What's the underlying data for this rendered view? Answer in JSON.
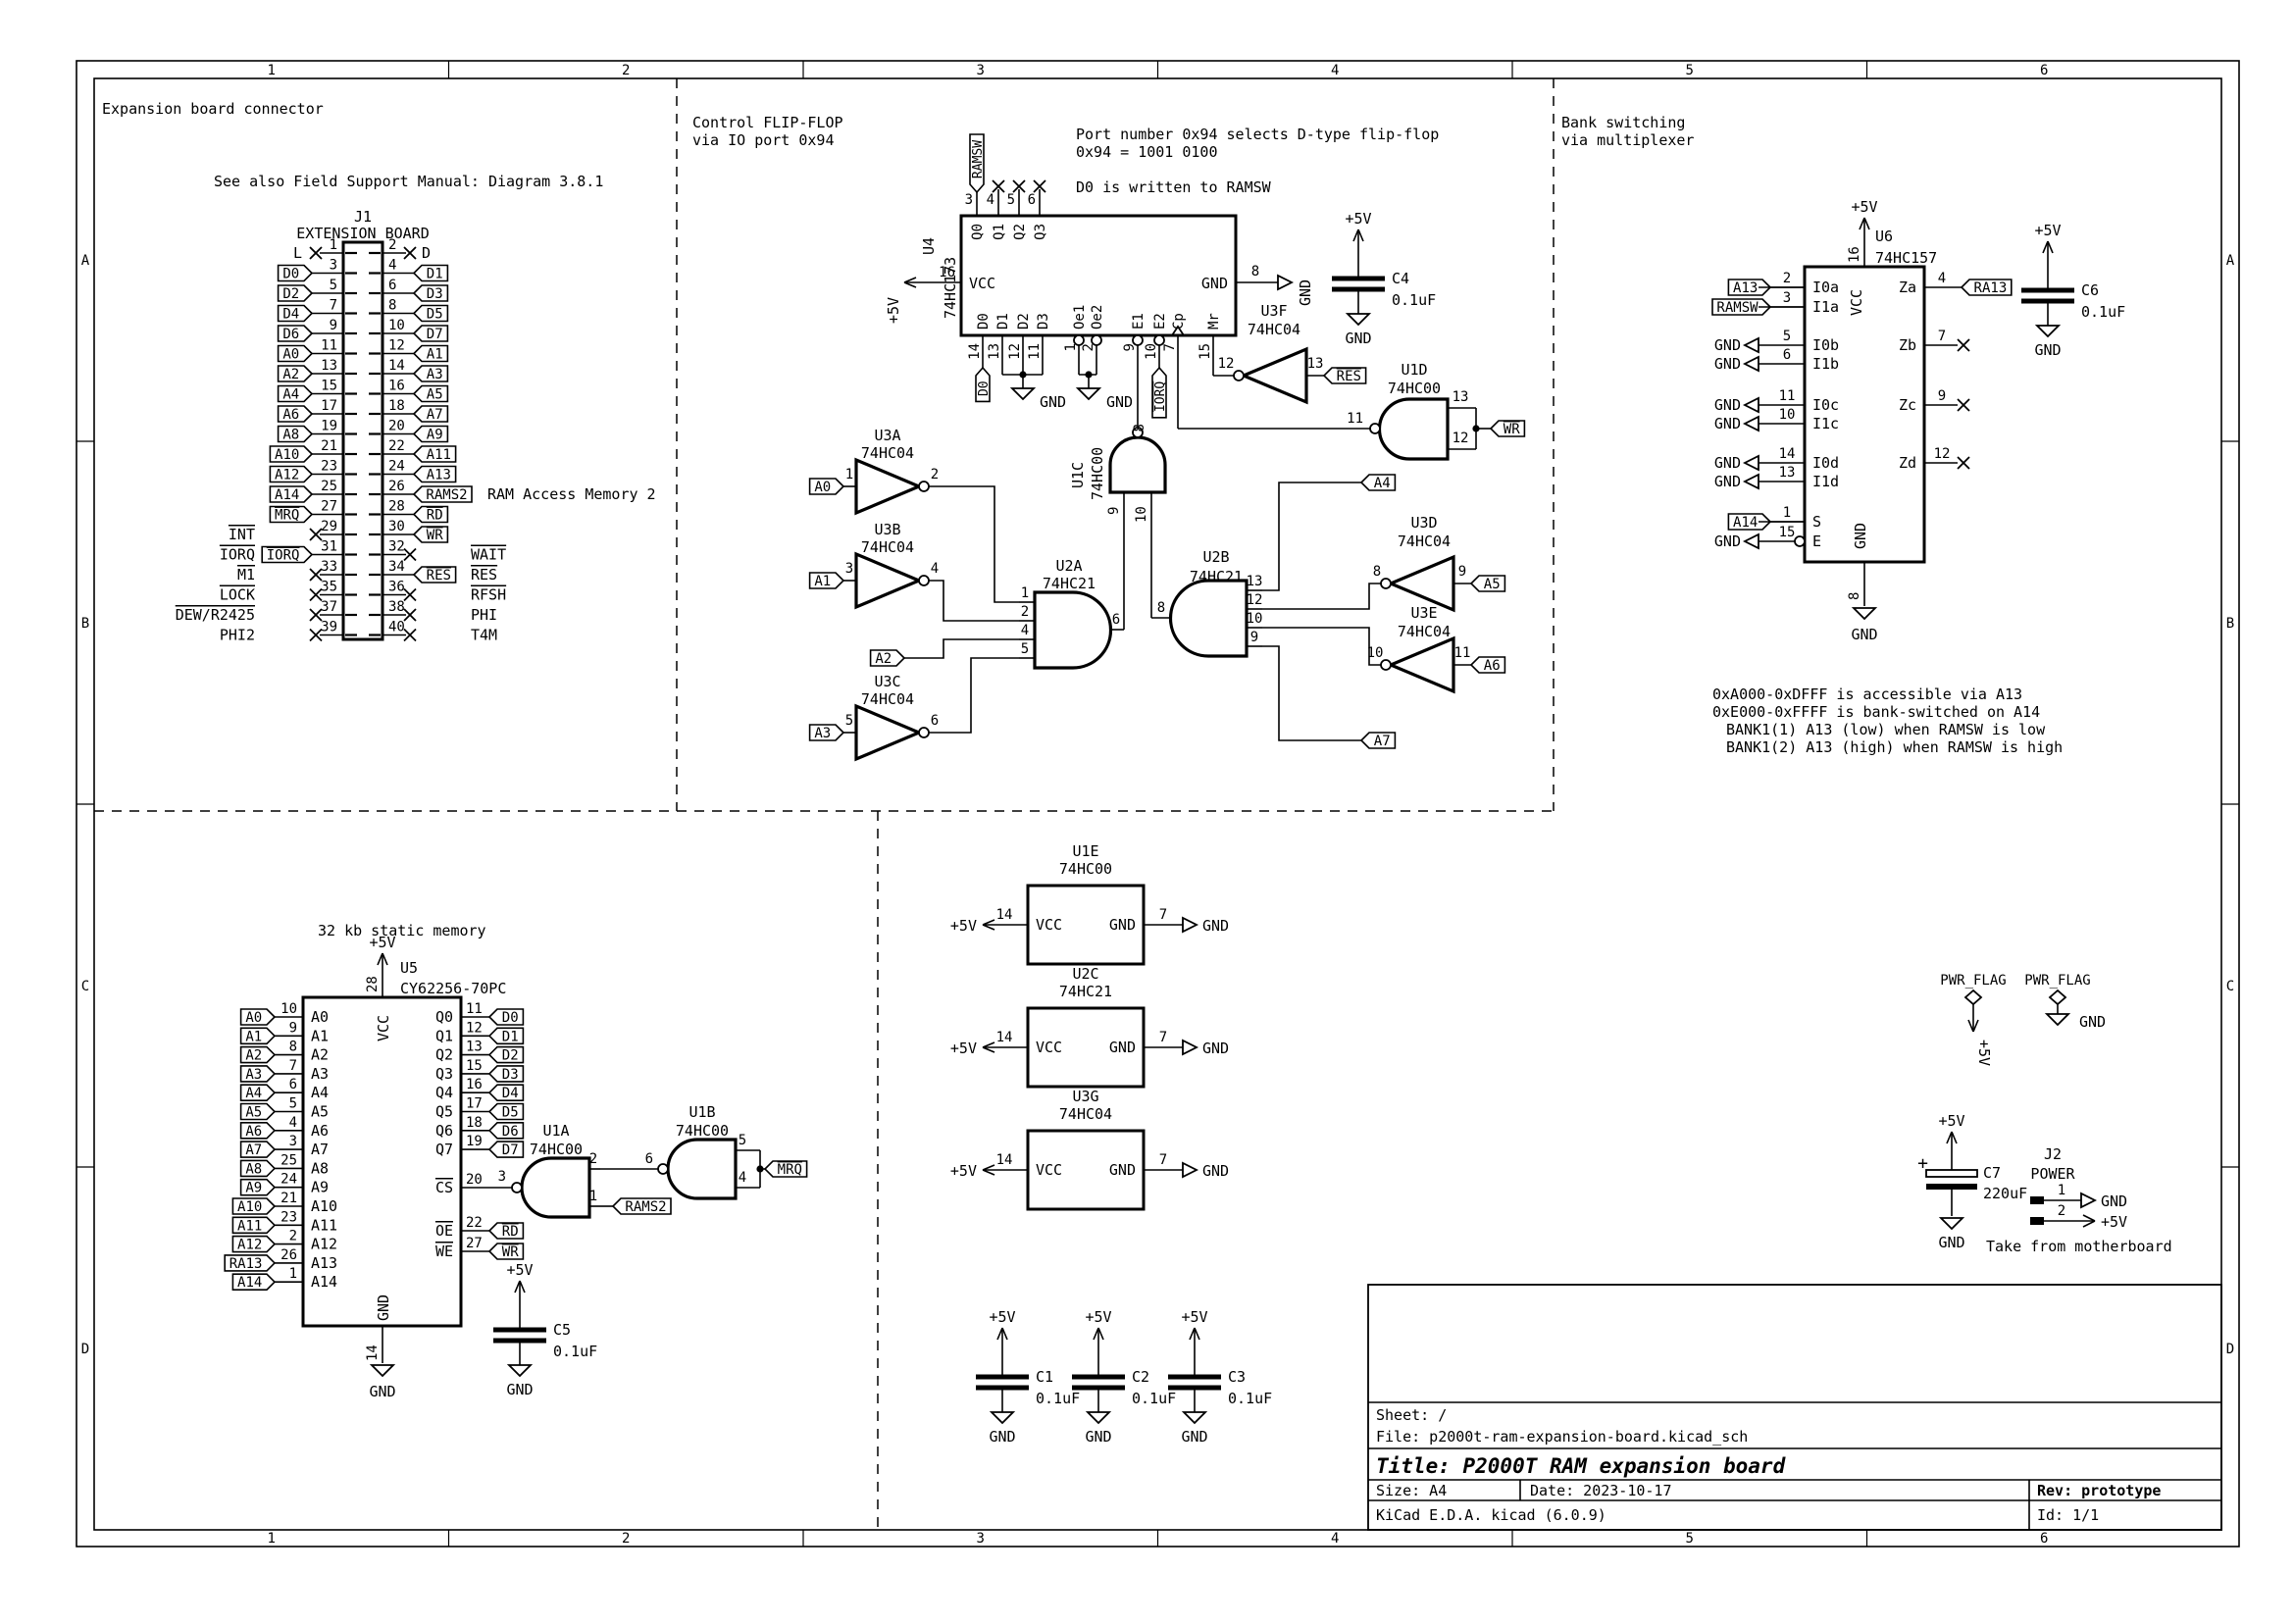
{
  "colors": {
    "background": "#ffffff",
    "ink": "#000000"
  },
  "nets": {
    "p5v": "+5V",
    "gnd": "GND"
  },
  "border": {
    "cols": [
      "1",
      "2",
      "3",
      "4",
      "5",
      "6"
    ],
    "rows": [
      "A",
      "B",
      "C",
      "D"
    ]
  },
  "title_block": {
    "sheet": "Sheet: /",
    "file": "File: p2000t-ram-expansion-board.kicad_sch",
    "title": "Title: P2000T RAM expansion board",
    "size": "Size: A4",
    "date": "Date: 2023-10-17",
    "rev": "Rev: prototype",
    "tool": "KiCad E.D.A.  kicad (6.0.9)",
    "id": "Id: 1/1"
  },
  "sections": {
    "expansion": {
      "heading": "Expansion board connector",
      "note": "See also Field Support Manual: Diagram 3.8.1"
    },
    "flipflop": {
      "heading1": "Control FLIP-FLOP",
      "heading2": "via IO port 0x94",
      "note1": "Port number 0x94 selects D-type flip-flop",
      "note2": "0x94 = 1001 0100",
      "note3": "D0 is written to RAMSW"
    },
    "bank": {
      "heading1": "Bank switching",
      "heading2": "via multiplexer",
      "notes": [
        "0xA000-0xDFFF is accessible via A13",
        "0xE000-0xFFFF is bank-switched on A14",
        "BANK1(1) A13 (low) when RAMSW is low",
        "BANK1(2) A13 (high) when RAMSW is high"
      ]
    },
    "memory": {
      "heading": "32 kb static memory"
    },
    "power": {}
  },
  "j1": {
    "ref": "J1",
    "value": "EXTENSION BOARD",
    "pin1_label": "L",
    "pin2_label": "D",
    "side_note": "RAM Access Memory 2",
    "rows": [
      {
        "ln": "1",
        "lx": 1,
        "rn": "2",
        "rx": 1
      },
      {
        "ln": "3",
        "lt": "D0",
        "rn": "4",
        "rt": "D1"
      },
      {
        "ln": "5",
        "lt": "D2",
        "rn": "6",
        "rt": "D3"
      },
      {
        "ln": "7",
        "lt": "D4",
        "rn": "8",
        "rt": "D5"
      },
      {
        "ln": "9",
        "lt": "D6",
        "rn": "10",
        "rt": "D7"
      },
      {
        "ln": "11",
        "lt": "A0",
        "rn": "12",
        "rt": "A1"
      },
      {
        "ln": "13",
        "lt": "A2",
        "rn": "14",
        "rt": "A3"
      },
      {
        "ln": "15",
        "lt": "A4",
        "rn": "16",
        "rt": "A5"
      },
      {
        "ln": "17",
        "lt": "A6",
        "rn": "18",
        "rt": "A7"
      },
      {
        "ln": "19",
        "lt": "A8",
        "rn": "20",
        "rt": "A9"
      },
      {
        "ln": "21",
        "lt": "A10",
        "rn": "22",
        "rt": "A11"
      },
      {
        "ln": "23",
        "lt": "A12",
        "rn": "24",
        "rt": "A13"
      },
      {
        "ln": "25",
        "lt": "A14",
        "rn": "26",
        "rt": "RAMS2"
      },
      {
        "ln": "27",
        "lt": "MRQ",
        "lov": 1,
        "rn": "28",
        "rt": "RD",
        "rov": 1
      },
      {
        "ln": "29",
        "lx": 1,
        "rn": "30",
        "rt": "WR",
        "rov": 1
      },
      {
        "ln": "31",
        "lt": "IORQ",
        "lov": 1,
        "rn": "32",
        "rx": 1
      },
      {
        "ln": "33",
        "lx": 1,
        "rn": "34",
        "rt": "RES",
        "rov": 1
      },
      {
        "ln": "35",
        "lx": 1,
        "rn": "36",
        "rx": 1
      },
      {
        "ln": "37",
        "lx": 1,
        "rn": "38",
        "rx": 1
      },
      {
        "ln": "39",
        "lx": 1,
        "rn": "40",
        "rx": 1
      }
    ],
    "left_signals": [
      {
        "row": 14,
        "t": "INT",
        "ov": 1
      },
      {
        "row": 15,
        "t": "IORQ",
        "ov": 1
      },
      {
        "row": 16,
        "t": "M1",
        "ov": 1
      },
      {
        "row": 17,
        "t": "LOCK",
        "ov": 1
      },
      {
        "row": 18,
        "t": "DEW/R2425",
        "ov": 1
      },
      {
        "row": 19,
        "t": "PHI2"
      }
    ],
    "right_signals": [
      {
        "row": 15,
        "t": "WAIT",
        "ov": 1
      },
      {
        "row": 16,
        "t": "RES",
        "ov": 1
      },
      {
        "row": 17,
        "t": "RFSH",
        "ov": 1
      },
      {
        "row": 18,
        "t": "PHI"
      },
      {
        "row": 19,
        "t": "T4M"
      }
    ]
  },
  "u4": {
    "ref": "U4",
    "value": "74HC173",
    "vcc_pin": "16",
    "vcc_name": "VCC",
    "gnd_pin": "8",
    "gnd_name": "GND",
    "top_pins": [
      {
        "n": "3",
        "name": "Q0",
        "tag": "RAMSW"
      },
      {
        "n": "4",
        "name": "Q1",
        "x": 1
      },
      {
        "n": "5",
        "name": "Q2",
        "x": 1
      },
      {
        "n": "6",
        "name": "Q3",
        "x": 1
      }
    ],
    "bottom_pins": [
      {
        "n": "14",
        "name": "D0",
        "tag": "D0"
      },
      {
        "n": "13",
        "name": "D1"
      },
      {
        "n": "12",
        "name": "D2"
      },
      {
        "n": "11",
        "name": "D3"
      },
      {
        "n": "1",
        "name": "Oe1",
        "bubble": 1
      },
      {
        "n": "2",
        "name": "Oe2",
        "bubble": 1
      },
      {
        "n": "9",
        "name": "E1",
        "bubble": 1
      },
      {
        "n": "10",
        "name": "E2",
        "bubble": 1,
        "tag": "IORQ",
        "tag_ov": 1
      },
      {
        "n": "7",
        "name": "Cp",
        "clock": 1
      },
      {
        "n": "15",
        "name": "Mr"
      }
    ]
  },
  "gates": {
    "u3a": {
      "ref": "U3A",
      "value": "74HC04",
      "nin": "1",
      "nout": "2",
      "tag": "A0"
    },
    "u3b": {
      "ref": "U3B",
      "value": "74HC04",
      "nin": "3",
      "nout": "4",
      "tag": "A1"
    },
    "u3c": {
      "ref": "U3C",
      "value": "74HC04",
      "nin": "5",
      "nout": "6",
      "tag": "A3"
    },
    "u3d": {
      "ref": "U3D",
      "value": "74HC04",
      "nin": "9",
      "nout": "8",
      "tag": "A5"
    },
    "u3e": {
      "ref": "U3E",
      "value": "74HC04",
      "nin": "11",
      "nout": "10",
      "tag": "A6"
    },
    "u3f": {
      "ref": "U3F",
      "value": "74HC04",
      "nin": "13",
      "nout": "12",
      "tag": "RES",
      "tag_ov": 1
    },
    "u1c": {
      "ref": "U1C",
      "value": "74HC00",
      "nin1": "9",
      "nin2": "10",
      "nout": "8"
    },
    "u1d": {
      "ref": "U1D",
      "value": "74HC00",
      "nin1": "13",
      "nin2": "12",
      "nout": "11",
      "tag": "WR",
      "tag_ov": 1
    },
    "u2a": {
      "ref": "U2A",
      "value": "74HC21",
      "nins": [
        "1",
        "2",
        "4",
        "5"
      ],
      "nout": "6",
      "a2_tag": "A2"
    },
    "u2b": {
      "ref": "U2B",
      "value": "74HC21",
      "nins": [
        "13",
        "12",
        "10",
        "9"
      ],
      "nout": "8",
      "tag_top": "A4",
      "tag_bottom": "A7"
    },
    "u1a": {
      "ref": "U1A",
      "value": "74HC00",
      "nin1": "2",
      "nin2": "1",
      "nout": "3",
      "tag": "RAMS2"
    },
    "u1b": {
      "ref": "U1B",
      "value": "74HC00",
      "nin1": "5",
      "nin2": "4",
      "nout": "6",
      "tag": "MRQ",
      "tag_ov": 1
    }
  },
  "u6": {
    "ref": "U6",
    "value": "74HC157",
    "vcc_pin": "16",
    "vcc_name": "VCC",
    "gnd_pin": "8",
    "gnd_name": "GND",
    "left_pins": [
      {
        "n": "2",
        "name": "I0a",
        "tag": "A13"
      },
      {
        "n": "3",
        "name": "I1a",
        "tag": "RAMSW"
      },
      {
        "n": "5",
        "name": "I0b",
        "gnd": 1
      },
      {
        "n": "6",
        "name": "I1b",
        "gnd": 1
      },
      {
        "n": "11",
        "name": "I0c",
        "gnd": 1
      },
      {
        "n": "10",
        "name": "I1c",
        "gnd": 1
      },
      {
        "n": "14",
        "name": "I0d",
        "gnd": 1
      },
      {
        "n": "13",
        "name": "I1d",
        "gnd": 1
      },
      {
        "n": "1",
        "name": "S",
        "tag": "A14"
      },
      {
        "n": "15",
        "name": "E",
        "gnd": 1,
        "bubble": 1
      }
    ],
    "right_pins": [
      {
        "n": "4",
        "name": "Za",
        "tag": "RA13"
      },
      {
        "n": "7",
        "name": "Zb",
        "x": 1
      },
      {
        "n": "9",
        "name": "Zc",
        "x": 1
      },
      {
        "n": "12",
        "name": "Zd",
        "x": 1
      }
    ]
  },
  "u5": {
    "ref": "U5",
    "value": "CY62256-70PC",
    "vcc_pin": "28",
    "vcc_name": "VCC",
    "gnd_pin": "14",
    "gnd_name": "GND",
    "left_pins": [
      {
        "n": "10",
        "name": "A0",
        "tag": "A0"
      },
      {
        "n": "9",
        "name": "A1",
        "tag": "A1"
      },
      {
        "n": "8",
        "name": "A2",
        "tag": "A2"
      },
      {
        "n": "7",
        "name": "A3",
        "tag": "A3"
      },
      {
        "n": "6",
        "name": "A4",
        "tag": "A4"
      },
      {
        "n": "5",
        "name": "A5",
        "tag": "A5"
      },
      {
        "n": "4",
        "name": "A6",
        "tag": "A6"
      },
      {
        "n": "3",
        "name": "A7",
        "tag": "A7"
      },
      {
        "n": "25",
        "name": "A8",
        "tag": "A8"
      },
      {
        "n": "24",
        "name": "A9",
        "tag": "A9"
      },
      {
        "n": "21",
        "name": "A10",
        "tag": "A10"
      },
      {
        "n": "23",
        "name": "A11",
        "tag": "A11"
      },
      {
        "n": "2",
        "name": "A12",
        "tag": "A12"
      },
      {
        "n": "26",
        "name": "A13",
        "tag": "RA13"
      },
      {
        "n": "1",
        "name": "A14",
        "tag": "A14"
      }
    ],
    "right_pins": [
      {
        "n": "11",
        "name": "Q0",
        "tag": "D0"
      },
      {
        "n": "12",
        "name": "Q1",
        "tag": "D1"
      },
      {
        "n": "13",
        "name": "Q2",
        "tag": "D2"
      },
      {
        "n": "15",
        "name": "Q3",
        "tag": "D3"
      },
      {
        "n": "16",
        "name": "Q4",
        "tag": "D4"
      },
      {
        "n": "17",
        "name": "Q5",
        "tag": "D5"
      },
      {
        "n": "18",
        "name": "Q6",
        "tag": "D6"
      },
      {
        "n": "19",
        "name": "Q7",
        "tag": "D7"
      }
    ],
    "cs": {
      "n": "20",
      "name": "CS"
    },
    "oe": {
      "n": "22",
      "name": "OE",
      "tag": "RD"
    },
    "we": {
      "n": "27",
      "name": "WE",
      "tag": "WR"
    }
  },
  "power_units": [
    {
      "ref": "U1E",
      "value": "74HC00",
      "vcc_pin": "14",
      "vcc_name": "VCC",
      "gnd_pin": "7",
      "gnd_name": "GND"
    },
    {
      "ref": "U2C",
      "value": "74HC21",
      "vcc_pin": "14",
      "vcc_name": "VCC",
      "gnd_pin": "7",
      "gnd_name": "GND"
    },
    {
      "ref": "U3G",
      "value": "74HC04",
      "vcc_pin": "14",
      "vcc_name": "VCC",
      "gnd_pin": "7",
      "gnd_name": "GND"
    }
  ],
  "caps": [
    {
      "ref": "C1",
      "value": "0.1uF"
    },
    {
      "ref": "C2",
      "value": "0.1uF"
    },
    {
      "ref": "C3",
      "value": "0.1uF"
    },
    {
      "ref": "C4",
      "value": "0.1uF"
    },
    {
      "ref": "C5",
      "value": "0.1uF"
    },
    {
      "ref": "C6",
      "value": "0.1uF"
    },
    {
      "ref": "C7",
      "value": "220uF"
    }
  ],
  "pwr_flags": {
    "label": "PWR_FLAG"
  },
  "j2": {
    "ref": "J2",
    "value": "POWER",
    "pins": [
      {
        "n": "1",
        "net": "GND"
      },
      {
        "n": "2",
        "net": "+5V"
      }
    ],
    "note": "Take from motherboard"
  }
}
